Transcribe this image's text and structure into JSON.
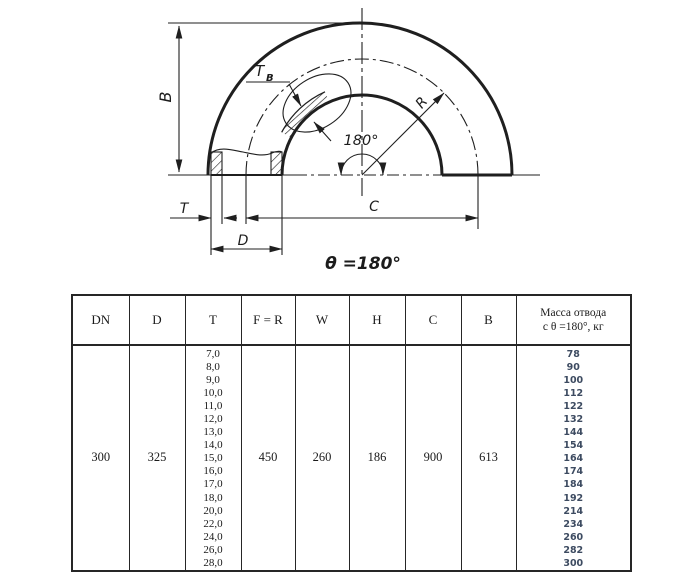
{
  "diagram": {
    "labels": {
      "b": "B",
      "t": "T",
      "d": "D",
      "c": "C",
      "r": "R",
      "tb_main": "T",
      "tb_sub": "B",
      "angle": "180°",
      "theta": "θ =180°"
    }
  },
  "table": {
    "headers": [
      "DN",
      "D",
      "T",
      "F = R",
      "W",
      "H",
      "C",
      "B",
      "Масса отвода\nс θ =180°, кг"
    ],
    "row": {
      "dn": "300",
      "d": "325",
      "fr": "450",
      "w": "260",
      "h": "186",
      "c": "900",
      "b": "613"
    },
    "t_values": [
      "7,0",
      "8,0",
      "9,0",
      "10,0",
      "11,0",
      "12,0",
      "13,0",
      "14,0",
      "15,0",
      "16,0",
      "17,0",
      "18,0",
      "20,0",
      "22,0",
      "24,0",
      "26,0",
      "28,0"
    ],
    "mass_values": [
      "78",
      "90",
      "100",
      "112",
      "122",
      "132",
      "144",
      "154",
      "164",
      "174",
      "184",
      "192",
      "214",
      "234",
      "260",
      "282",
      "300"
    ]
  },
  "colors": {
    "line": "#1f1f1f",
    "mass_text": "#3d4b61"
  }
}
